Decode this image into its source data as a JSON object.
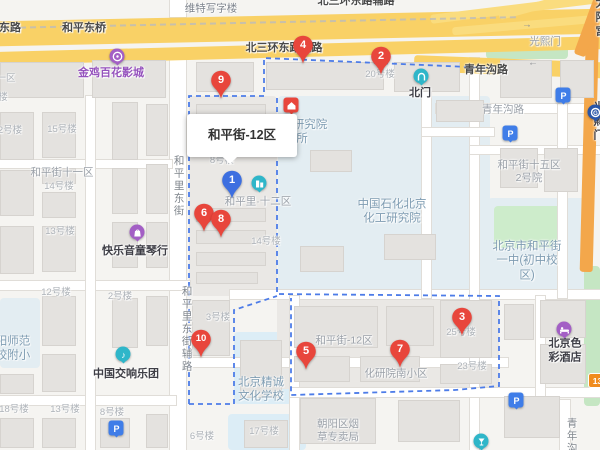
{
  "map": {
    "popup": {
      "title": "和平街-12区"
    },
    "colors": {
      "purple": "#a35fc5",
      "teal": "#2fb6c9",
      "red": "#e8463c",
      "blue": "#3f7de8",
      "subway": "#2a56a8",
      "orange": "#f08c1e",
      "boundary": "#4d7ce8"
    },
    "pins": [
      {
        "label": "9",
        "x": 221,
        "y": 81,
        "color": "#e8463c"
      },
      {
        "label": "4",
        "x": 303,
        "y": 46,
        "color": "#e8463c"
      },
      {
        "label": "2",
        "x": 381,
        "y": 57,
        "color": "#e8463c"
      },
      {
        "label": "1",
        "x": 232,
        "y": 181,
        "color": "#3d6fe0"
      },
      {
        "label": "6",
        "x": 204,
        "y": 214,
        "color": "#e8463c"
      },
      {
        "label": "8",
        "x": 221,
        "y": 220,
        "color": "#e8463c"
      },
      {
        "label": "10",
        "x": 201,
        "y": 340,
        "color": "#e8463c"
      },
      {
        "label": "5",
        "x": 306,
        "y": 352,
        "color": "#e8463c"
      },
      {
        "label": "7",
        "x": 400,
        "y": 350,
        "color": "#e8463c"
      },
      {
        "label": "3",
        "x": 462,
        "y": 318,
        "color": "#e8463c"
      }
    ],
    "labels": [
      {
        "text": "东路",
        "x": 10,
        "y": 29,
        "cls": "road"
      },
      {
        "text": "和平东桥",
        "x": 84,
        "y": 29,
        "cls": "road"
      },
      {
        "text": "北三环东路辅路",
        "x": 356,
        "y": 2,
        "cls": "road"
      },
      {
        "text": "北三环东路辅路",
        "x": 284,
        "y": 49,
        "cls": "road"
      },
      {
        "text": "青年沟路",
        "x": 486,
        "y": 71,
        "cls": "road"
      },
      {
        "text": "太阳宫",
        "x": 601,
        "y": 18,
        "cls": "road"
      },
      {
        "text": "维特写字楼",
        "x": 211,
        "y": 9,
        "cls": "bldgdark"
      },
      {
        "text": "光熙门",
        "x": 545,
        "y": 42,
        "cls": "area"
      },
      {
        "text": "青年沟路",
        "x": 503,
        "y": 110,
        "cls": "gray"
      },
      {
        "text": "青年沟",
        "x": 571,
        "y": 436,
        "cls": "grayv"
      },
      {
        "text": "和平里东街",
        "x": 178,
        "y": 186,
        "cls": "grayv"
      },
      {
        "text": "和平里东街辅路",
        "x": 186,
        "y": 329,
        "cls": "grayv"
      },
      {
        "text": "一区",
        "x": 6,
        "y": 79,
        "cls": "bldg"
      },
      {
        "text": "楼",
        "x": 3,
        "y": 98,
        "cls": "bldg"
      },
      {
        "text": "2号楼",
        "x": 10,
        "y": 131,
        "cls": "bldg"
      },
      {
        "text": "15号楼",
        "x": 62,
        "y": 130,
        "cls": "bldg"
      },
      {
        "text": "和平街十一区",
        "x": 62,
        "y": 173,
        "cls": "area"
      },
      {
        "text": "14号楼",
        "x": 59,
        "y": 187,
        "cls": "bldg"
      },
      {
        "text": "13号楼",
        "x": 60,
        "y": 232,
        "cls": "bldg"
      },
      {
        "text": "20号楼",
        "x": 380,
        "y": 75,
        "cls": "bldg"
      },
      {
        "text": "8号楼",
        "x": 222,
        "y": 161,
        "cls": "bldg"
      },
      {
        "text": "和平里·十二区",
        "x": 258,
        "y": 202,
        "cls": "area"
      },
      {
        "text": "14号楼",
        "x": 266,
        "y": 242,
        "cls": "bldg"
      },
      {
        "text": "3号楼",
        "x": 218,
        "y": 318,
        "cls": "bldg"
      },
      {
        "text": "12号楼",
        "x": 56,
        "y": 293,
        "cls": "bldg"
      },
      {
        "text": "2号楼",
        "x": 120,
        "y": 297,
        "cls": "bldg"
      },
      {
        "text": "18号楼",
        "x": 14,
        "y": 410,
        "cls": "bldg"
      },
      {
        "text": "13号楼",
        "x": 65,
        "y": 410,
        "cls": "bldg"
      },
      {
        "text": "8号楼",
        "x": 112,
        "y": 413,
        "cls": "bldg"
      },
      {
        "text": "6号楼",
        "x": 202,
        "y": 437,
        "cls": "bldg"
      },
      {
        "text": "17号楼",
        "x": 264,
        "y": 432,
        "cls": "bldg"
      },
      {
        "text": "和平街-12区",
        "x": 344,
        "y": 341,
        "cls": "area"
      },
      {
        "text": "化研院南小区",
        "x": 396,
        "y": 374,
        "cls": "area"
      },
      {
        "text": "朝阳区烟\n草专卖局",
        "x": 338,
        "y": 431,
        "cls": "area"
      },
      {
        "text": "25号楼",
        "x": 461,
        "y": 333,
        "cls": "bldg"
      },
      {
        "text": "23号楼",
        "x": 472,
        "y": 367,
        "cls": "bldg"
      },
      {
        "text": "和平街十五区\n2号院",
        "x": 529,
        "y": 172,
        "cls": "area"
      },
      {
        "text": "中国石化北京\n化工研究院",
        "x": 392,
        "y": 212,
        "cls": "campus"
      },
      {
        "text": "北京市和平街\n一中(初中校区)",
        "x": 527,
        "y": 261,
        "cls": "campus"
      },
      {
        "text": "北京精诚\n文化学校",
        "x": 261,
        "y": 390,
        "cls": "campus"
      },
      {
        "text": "阳师范\n校附小",
        "x": 13,
        "y": 349,
        "cls": "campus"
      },
      {
        "text": "研究院",
        "x": 310,
        "y": 125,
        "cls": "campus"
      },
      {
        "text": "所",
        "x": 302,
        "y": 139,
        "cls": "campus"
      },
      {
        "text": "金鸡百花影城",
        "x": 111,
        "y": 74,
        "cls": "poipurple"
      },
      {
        "text": "快乐音童琴行",
        "x": 135,
        "y": 252,
        "cls": "poi"
      },
      {
        "text": "中国交响乐团",
        "x": 126,
        "y": 375,
        "cls": "poi"
      },
      {
        "text": "北门",
        "x": 420,
        "y": 94,
        "cls": "poi"
      },
      {
        "text": "北京色彩酒店",
        "x": 565,
        "y": 351,
        "cls": "poi"
      },
      {
        "text": "光熙门",
        "x": 599,
        "y": 122,
        "cls": "poi"
      }
    ],
    "pois": [
      {
        "icon": "cinema-icon",
        "x": 117,
        "y": 57,
        "color": "#a35fc5",
        "shape": "circle"
      },
      {
        "icon": "shop-icon",
        "x": 137,
        "y": 233,
        "color": "#a35fc5",
        "shape": "circle"
      },
      {
        "icon": "orchestra-icon",
        "x": 123,
        "y": 355,
        "color": "#2fb6c9",
        "shape": "circle"
      },
      {
        "icon": "community-icon",
        "x": 259,
        "y": 184,
        "color": "#2fb6c9",
        "shape": "circle"
      },
      {
        "icon": "gate-icon",
        "x": 421,
        "y": 77,
        "color": "#2fb6c9",
        "shape": "circle"
      },
      {
        "icon": "hotel-icon",
        "x": 564,
        "y": 330,
        "color": "#a35fc5",
        "shape": "circle"
      },
      {
        "icon": "drink-icon",
        "x": 481,
        "y": 442,
        "color": "#2fb6c9",
        "shape": "circle"
      },
      {
        "icon": "house-icon",
        "x": 291,
        "y": 106,
        "color": "#e8463c",
        "shape": "square"
      },
      {
        "icon": "subway-station-icon",
        "x": 595,
        "y": 113,
        "color": "#2a56a8",
        "shape": "circle"
      },
      {
        "icon": "parking-icon",
        "x": 563,
        "y": 96,
        "color": "#3f7de8",
        "shape": "square"
      },
      {
        "icon": "parking-icon",
        "x": 510,
        "y": 134,
        "color": "#3f7de8",
        "shape": "square"
      },
      {
        "icon": "parking-icon",
        "x": 516,
        "y": 401,
        "color": "#3f7de8",
        "shape": "square"
      },
      {
        "icon": "parking-icon",
        "x": 116,
        "y": 429,
        "color": "#3f7de8",
        "shape": "square"
      }
    ],
    "badges": [
      {
        "text": "13",
        "x": 588,
        "y": 373
      }
    ],
    "arrows": [
      {
        "glyph": "→",
        "x": 527,
        "y": 25
      },
      {
        "glyph": "←",
        "x": 533,
        "y": 63
      },
      {
        "glyph": "←",
        "x": 491,
        "y": 73
      },
      {
        "glyph": "↓",
        "x": 565,
        "y": 360
      }
    ],
    "geometry": {
      "areas": [
        [
          278,
          96,
          212,
          200,
          "#e3edf2"
        ],
        [
          488,
          198,
          104,
          98,
          "#e3edf2"
        ],
        [
          494,
          206,
          72,
          42,
          "#cdeccb"
        ],
        [
          234,
          332,
          58,
          72,
          "#dcedf6"
        ],
        [
          228,
          414,
          78,
          36,
          "#dcedf6"
        ],
        [
          0,
          298,
          40,
          70,
          "#e3edf2"
        ],
        [
          189,
          96,
          88,
          200,
          "#eae8e5"
        ],
        [
          277,
          296,
          222,
          93,
          "#eae8e5"
        ],
        [
          486,
          46,
          82,
          13,
          "#c5e6c3"
        ],
        [
          584,
          266,
          16,
          140,
          "#c5e6c3"
        ]
      ],
      "roads_white": [
        [
          170,
          0,
          16,
          17
        ],
        [
          170,
          56,
          16,
          394
        ],
        [
          0,
          160,
          172,
          8
        ],
        [
          0,
          281,
          190,
          9
        ],
        [
          0,
          396,
          176,
          9
        ],
        [
          86,
          96,
          9,
          354
        ],
        [
          186,
          358,
          322,
          9
        ],
        [
          230,
          290,
          372,
          9
        ],
        [
          290,
          296,
          9,
          154
        ],
        [
          422,
          58,
          9,
          240
        ],
        [
          470,
          58,
          9,
          392
        ],
        [
          436,
          104,
          166,
          9
        ],
        [
          470,
          146,
          132,
          8
        ],
        [
          290,
          388,
          312,
          9
        ],
        [
          536,
          296,
          9,
          100
        ],
        [
          422,
          128,
          72,
          8
        ],
        [
          558,
          104,
          9,
          194
        ],
        [
          560,
          400,
          10,
          50
        ]
      ],
      "roads_yellow": [
        [
          -8,
          15,
          616,
          25,
          -1.2,
          "#f9d166"
        ],
        [
          -8,
          44,
          620,
          13,
          -1.5,
          "#f9d166"
        ],
        [
          414,
          59,
          200,
          16,
          2.2,
          "#f9d166"
        ],
        [
          430,
          3,
          195,
          9,
          -7,
          "#fadc7e"
        ],
        [
          452,
          20,
          170,
          8,
          -5,
          "#fadc7e"
        ],
        [
          497,
          -4,
          125,
          8,
          -15,
          "#fadc7e"
        ],
        [
          583,
          18,
          13,
          254,
          1.5,
          "#f3a74b"
        ],
        [
          588,
          -28,
          12,
          86,
          20,
          "#f3a74b"
        ]
      ],
      "buildings": [
        [
          0,
          62,
          84,
          36
        ],
        [
          92,
          60,
          74,
          38
        ],
        [
          196,
          62,
          58,
          30
        ],
        [
          266,
          62,
          118,
          28
        ],
        [
          394,
          62,
          66,
          30
        ],
        [
          0,
          112,
          34,
          48
        ],
        [
          42,
          112,
          34,
          46
        ],
        [
          112,
          102,
          26,
          58
        ],
        [
          146,
          104,
          22,
          52
        ],
        [
          0,
          170,
          34,
          46
        ],
        [
          42,
          168,
          34,
          16
        ],
        [
          42,
          192,
          34,
          26
        ],
        [
          112,
          168,
          26,
          46
        ],
        [
          146,
          164,
          22,
          50
        ],
        [
          0,
          226,
          34,
          48
        ],
        [
          42,
          226,
          34,
          46
        ],
        [
          112,
          222,
          26,
          46
        ],
        [
          146,
          222,
          22,
          46
        ],
        [
          42,
          296,
          34,
          50
        ],
        [
          112,
          298,
          26,
          50
        ],
        [
          146,
          296,
          22,
          50
        ],
        [
          0,
          374,
          34,
          20
        ],
        [
          42,
          354,
          34,
          38
        ],
        [
          0,
          418,
          34,
          30
        ],
        [
          42,
          418,
          34,
          30
        ],
        [
          100,
          418,
          30,
          30
        ],
        [
          146,
          414,
          22,
          34
        ],
        [
          196,
          104,
          70,
          12
        ],
        [
          196,
          208,
          70,
          14
        ],
        [
          196,
          230,
          70,
          14
        ],
        [
          196,
          252,
          70,
          14
        ],
        [
          196,
          272,
          62,
          12
        ],
        [
          192,
          300,
          38,
          56
        ],
        [
          294,
          306,
          84,
          42
        ],
        [
          386,
          306,
          48,
          40
        ],
        [
          294,
          356,
          56,
          26
        ],
        [
          360,
          356,
          60,
          26
        ],
        [
          440,
          300,
          52,
          58
        ],
        [
          440,
          364,
          52,
          20
        ],
        [
          310,
          150,
          42,
          22
        ],
        [
          300,
          246,
          44,
          26
        ],
        [
          384,
          234,
          52,
          26
        ],
        [
          436,
          100,
          48,
          22
        ],
        [
          500,
          60,
          52,
          38
        ],
        [
          560,
          60,
          34,
          38
        ],
        [
          500,
          148,
          38,
          40
        ],
        [
          544,
          148,
          34,
          44
        ],
        [
          540,
          300,
          46,
          38
        ],
        [
          504,
          304,
          30,
          36
        ],
        [
          540,
          344,
          46,
          40
        ],
        [
          504,
          396,
          56,
          42
        ],
        [
          300,
          398,
          76,
          46
        ],
        [
          398,
          400,
          62,
          42
        ],
        [
          240,
          340,
          42,
          58
        ],
        [
          244,
          420,
          44,
          28
        ]
      ],
      "boundary_paths": [
        [
          [
            189,
            404
          ],
          [
            189,
            96
          ],
          [
            264,
            96
          ],
          [
            264,
            58
          ],
          [
            492,
            68
          ]
        ],
        [
          [
            277,
            98
          ],
          [
            277,
            294
          ],
          [
            499,
            296
          ],
          [
            499,
            386
          ],
          [
            455,
            390
          ],
          [
            291,
            395
          ],
          [
            291,
            298
          ]
        ],
        [
          [
            189,
            404
          ],
          [
            234,
            404
          ],
          [
            234,
            310
          ],
          [
            277,
            296
          ]
        ]
      ]
    }
  }
}
